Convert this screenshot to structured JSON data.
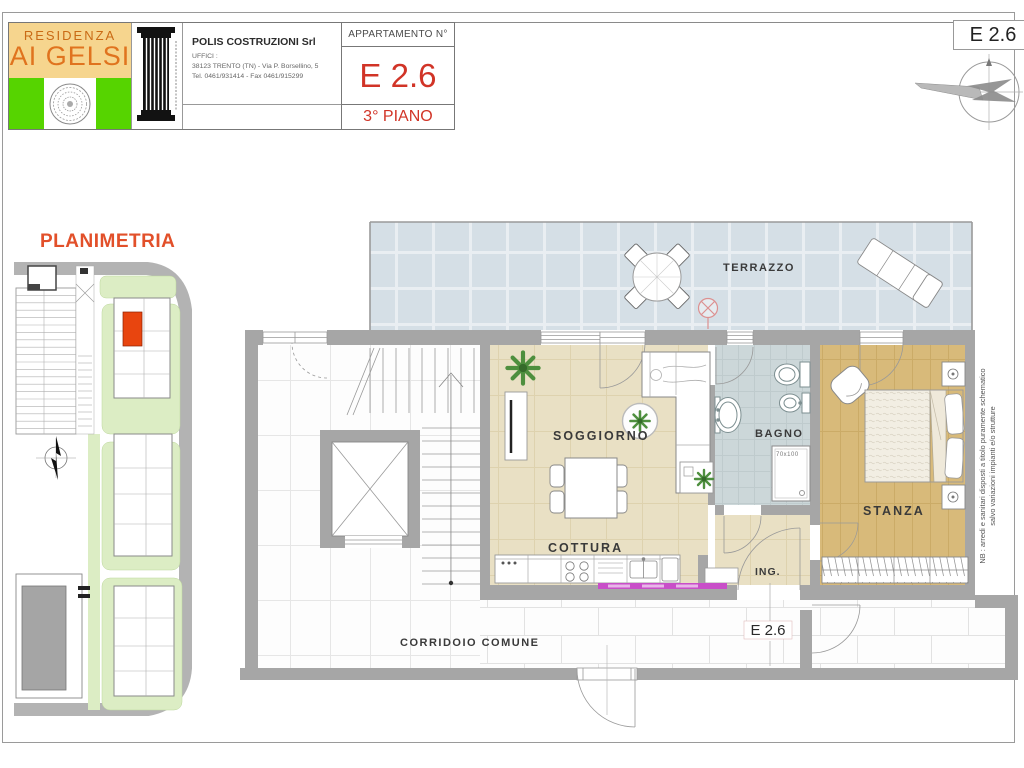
{
  "header": {
    "logo": {
      "line1": "RESIDENZA",
      "line2": "AI GELSI"
    },
    "builder": {
      "name": "POLIS COSTRUZIONI Srl",
      "office": "UFFICI :",
      "address": "38123 TRENTO (TN) - Via P. Borsellino, 5",
      "phone": "Tel. 0461/931414 - Fax 0461/915299"
    },
    "apartment": {
      "label": "APPARTAMENTO N°",
      "number": "E 2.6",
      "floor": "3° PIANO"
    },
    "unit_ref": "E 2.6"
  },
  "site_plan": {
    "title": "PLANIMETRIA"
  },
  "floor_plan": {
    "labels": {
      "terrace": "TERRAZZO",
      "living": "SOGGIORNO",
      "kitchen": "COTTURA",
      "bath": "BAGNO",
      "bath_shower": "70x100",
      "bedroom": "STANZA",
      "entry": "ING.",
      "corridor": "CORRIDOIO COMUNE",
      "unit_door": "E 2.6"
    },
    "note_line1": "NB : arredi e sanitari disposti a titolo puramente schematico",
    "note_line2": "salvo variazioni impianti e/o strutture"
  },
  "colors": {
    "accent_red": "#d13427",
    "accent_orange": "#e0731e",
    "logo_green": "#56d400",
    "logo_cream": "#f6d58e",
    "planimetria_title": "#e2502a",
    "highlight_unit": "#e8450f",
    "wall_gray": "#a6a6a6",
    "terrace_tile": "#d5dfe6",
    "living_floor": "#e9e0c4",
    "bath_floor": "#ccd7d9",
    "bedroom_floor": "#d8ba7a",
    "kitchen_strip": "#c84fc8"
  }
}
